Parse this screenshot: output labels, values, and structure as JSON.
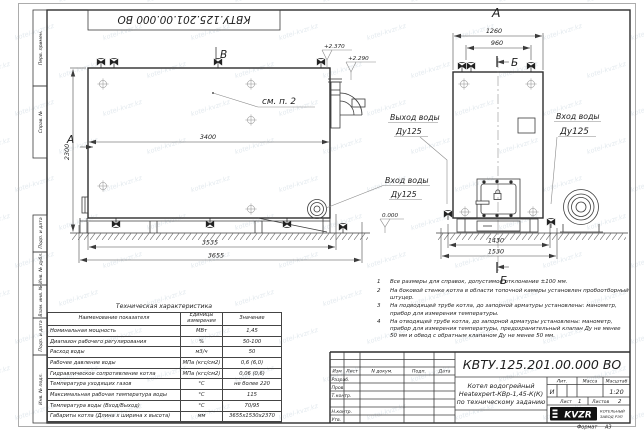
{
  "sheet": {
    "stamp_top": "КВТУ.125.201.00.000  ВО",
    "format_label": "Формат",
    "format_value": "А3",
    "watermark": "kotel-kvzr.kz",
    "margin_labels": [
      "Перв. примен.",
      "Справ. №",
      "Подп. и дата",
      "Инв. № дубл.",
      "Взам. инв. №",
      "Подп. и дата",
      "Инв. № подл."
    ]
  },
  "views": {
    "side": {
      "section_a": "А",
      "section_b": "В",
      "callout_note": "см. п. 2",
      "dim_width_top": "3400",
      "dim_height": "2300",
      "dim_bottom_1": "3535",
      "dim_bottom_2": "3655",
      "elev_1": "+2.370",
      "elev_2": "+2.290",
      "inlet_line1": "Вход воды",
      "inlet_line2": "Ду125"
    },
    "front": {
      "view_label": "А",
      "section_mark": "Б",
      "dim_top_1": "1260",
      "dim_top_2": "960",
      "dim_bottom_1": "1430",
      "dim_bottom_2": "1530",
      "elev_zero": "0.000",
      "outlet_line1": "Выход воды",
      "outlet_line2": "Ду125",
      "inlet_line1": "Вход воды",
      "inlet_line2": "Ду125"
    }
  },
  "tech_table": {
    "title": "Техническая характеристика",
    "headers": [
      "Наименование показателя",
      "Единицы измерения",
      "Значение"
    ],
    "rows": [
      [
        "Номинальная мощность",
        "МВт",
        "1,45"
      ],
      [
        "Диапазон рабочего регулирования",
        "%",
        "50-100"
      ],
      [
        "Расход воды",
        "м3/ч",
        "50"
      ],
      [
        "Рабочее давление воды",
        "МПа (кгс/см2)",
        "0,6 (6,0)"
      ],
      [
        "Гидравлическое сопротивление котла",
        "МПа (кгс/см2)",
        "0,06 (0,6)"
      ],
      [
        "Температура уходящих газов",
        "°С",
        "не более 220"
      ],
      [
        "Максимальная рабочая температура воды",
        "°С",
        "115"
      ],
      [
        "Температура воды (Вход/Выход)",
        "°С",
        "70/95"
      ],
      [
        "Габариты котла (Длина х ширина х высота)",
        "мм",
        "3655х1530х2370"
      ]
    ]
  },
  "notes": {
    "items": [
      {
        "num": "1",
        "text": "Все размеры для справок, допустимое отклонение ±100 мм."
      },
      {
        "num": "2",
        "text": "На боковой стенке котла в области топочной камеры установлен пробоотборный штуцер."
      },
      {
        "num": "3",
        "text": "На подводящей трубе котла, до запорной арматуры установлены: манометр, прибор для измерения температуры."
      },
      {
        "num": "4",
        "text": "На отводящей трубе котла, до запорной арматуры установлены: манометр, прибор для измерения температуры, предохранительный клапан Ду не менее 50 мм и обвод с обратным клапаном Ду не менее 50 мм."
      }
    ]
  },
  "title_block": {
    "designation": "КВТУ.125.201.00.000  ВО",
    "doc_name_lines": [
      "Котел водогрейный",
      "Heatexpert-КВр-1,45-К(К)",
      "по техническому заданию"
    ],
    "header_cells": [
      "Изм",
      "Лист",
      "N докум.",
      "Подп.",
      "Дата"
    ],
    "sig_rows": [
      "Разраб.",
      "Пров.",
      "Т.контр.",
      "Н.контр.",
      "Утв."
    ],
    "lit_label": "Лит.",
    "mass_label": "Масса",
    "scale_label": "Масштаб",
    "lit_value": "И",
    "scale_value": "1:20",
    "sheet_label": "Лист",
    "sheet_value": "1",
    "sheets_label": "Листов",
    "sheets_value": "2",
    "logo_text": "KVZR",
    "company_line1": "КОТЕЛЬНЫЙ",
    "company_line2": "ЗАВОД РЭП"
  }
}
